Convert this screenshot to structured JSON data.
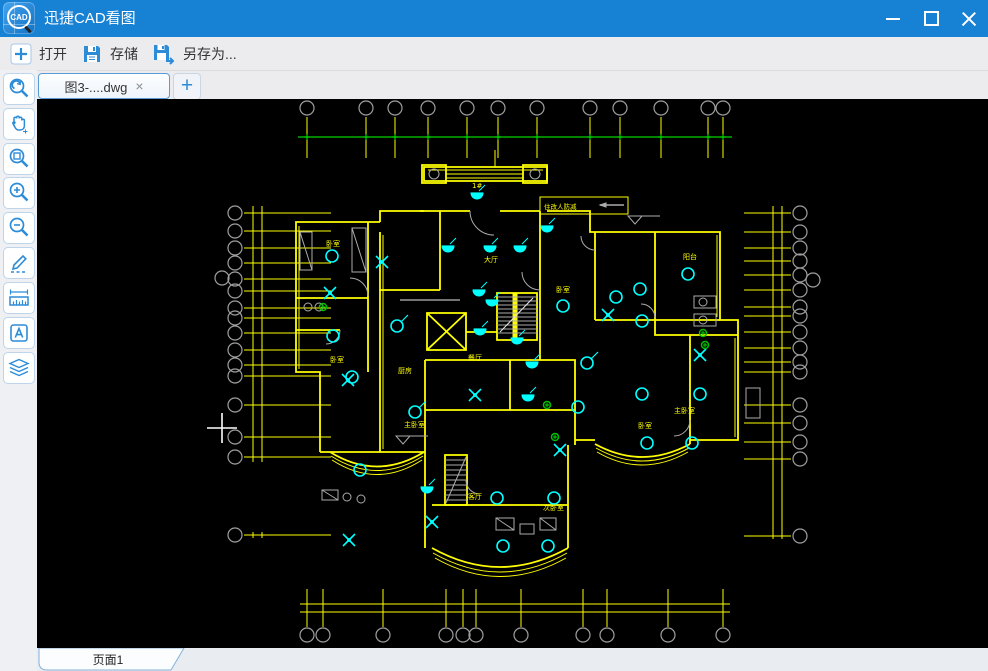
{
  "window": {
    "title": "迅捷CAD看图",
    "logo_text": "CAD",
    "controls": [
      "minimize-icon",
      "maximize-icon",
      "close-icon"
    ]
  },
  "toolbar": {
    "items": [
      {
        "label": "打开",
        "icon": "plus-box-icon"
      },
      {
        "label": "存储",
        "icon": "save-icon"
      },
      {
        "label": "另存为...",
        "icon": "save-as-icon"
      }
    ]
  },
  "tabs": {
    "active": {
      "label": "图3-....dwg",
      "close_glyph": "×"
    },
    "new_tab_glyph": "+"
  },
  "sidebar": {
    "tools": [
      "zoom-extents",
      "pan",
      "zoom-window",
      "zoom-in",
      "zoom-out",
      "draw",
      "measure",
      "text",
      "layers"
    ]
  },
  "statusbar": {
    "page_tab": "页面1"
  },
  "drawing": {
    "palette": {
      "wall": "#ffff00",
      "symbol": "#00ffff",
      "axis": "#9f9f9f",
      "datum": "#00d400",
      "detail": "#ababab",
      "green": "#00c000",
      "label": "#ffff00",
      "cursor": "#ffffff",
      "white": "#e8e8e8"
    },
    "axis_top": {
      "cy": 108,
      "r": 7,
      "xs": [
        307,
        366,
        395,
        428,
        467,
        498,
        537,
        590,
        620,
        661,
        708,
        723
      ],
      "tick": [
        117,
        158
      ],
      "datum_y": 137,
      "datum_x": [
        298,
        732
      ]
    },
    "axis_bottom": {
      "cy": 635,
      "r": 7,
      "xs": [
        307,
        323,
        383,
        446,
        463,
        476,
        521,
        583,
        607,
        668,
        723
      ],
      "tick": [
        589,
        627
      ],
      "hlines": [
        604,
        612
      ],
      "hx": [
        300,
        730
      ]
    },
    "axis_left": {
      "cx": 235,
      "r": 7,
      "ys": [
        213,
        231,
        248,
        263,
        279,
        291,
        308,
        318,
        333,
        350,
        365,
        376,
        405,
        437,
        457,
        535
      ],
      "extra": [
        222,
        278
      ],
      "tick": [
        244,
        331
      ],
      "vxs": [
        253,
        262
      ],
      "vy": [
        206,
        462
      ]
    },
    "axis_right": {
      "cx": 800,
      "r": 7,
      "ys": [
        213,
        232,
        248,
        261,
        275,
        290,
        307,
        316,
        332,
        348,
        362,
        372,
        405,
        423,
        442,
        459,
        536
      ],
      "extra": [
        813,
        280
      ],
      "tick": [
        744,
        791
      ],
      "vxs": [
        773,
        782
      ],
      "vy": [
        206,
        537
      ]
    },
    "walls": [
      "M380,222 H296 V372 H320 V452",
      "M380,222 V211 H424",
      "M424,167 H547 V181 H424 Z",
      "M422,165 H446 V183 H422 Z",
      "M523,165 H547 V183 H523 Z",
      "M420,211 H470 M500,211 H540",
      "M440,211 V290",
      "M540,211 V360",
      "M547,211 H590 V232 H720 V320 H738 V440 H690",
      "M595,232 V320",
      "M655,232 V320",
      "M595,320 H720",
      "M655,320 V335 H738",
      "M690,335 V444",
      "M380,232 V452",
      "M368,222 V372",
      "M296,298 H368",
      "M296,330 H340",
      "M380,290 H440",
      "M425,360 H540",
      "M425,360 V452",
      "M510,360 V410",
      "M425,410 H575",
      "M540,360 H575 V445",
      "M320,452 H425",
      "M425,452 V548",
      "M568,548 V445",
      "M575,440 H595",
      "M432,505 H568",
      "M427,313 H466 V350 H427 Z",
      "M427,313 L466,350 M466,313 L427,350",
      "M497,293 H537 V340 H497 Z",
      "M445,455 H467 V505 H445 Z",
      "M466,332 H497",
      "M330,452 Q377,481 424,452",
      "M432,548 Q500,586 568,548",
      "M595,444 Q642,470 690,444"
    ],
    "thick": [
      "M515,293 V340"
    ],
    "thin": [
      "M299,226 V369",
      "M383,235 V449",
      "M717,235 V317",
      "M735,338 V437",
      "M428,170 H543",
      "M446,174 H523",
      "M446,178 H523",
      "M495,150 V167",
      "M331,456 Q377,485 423,456",
      "M332,460 Q377,489 422,460",
      "M433,553 Q500,591 567,553",
      "M435,558 Q500,595 566,558",
      "M596,448 Q642,474 689,448",
      "M597,452 Q642,478 688,452"
    ],
    "gray": [
      "M497,297 H537 M497,301 H537 M497,305 H537 M497,309 H537 M497,313 H537 M497,317 H537 M497,321 H537 M497,325 H537 M497,329 H537 M497,333 H537",
      "M445,460 H467 M445,465 H467 M445,470 H467 M445,475 H467 M445,480 H467 M445,485 H467 M445,490 H467 M445,495 H467 M445,500 H467",
      "M446,503 L466,457",
      "M470,211 A24,24 0 0 0 494,235",
      "M368,296 A18,18 0 0 0 350,278",
      "M340,330 A14,14 0 0 1 326,344",
      "M540,290 A18,18 0 0 1 522,272",
      "M655,318 A14,14 0 0 0 641,304",
      "M690,420 A16,16 0 0 1 674,436",
      "M466,480 A14,14 0 0 0 480,494",
      "M595,250 A14,14 0 0 1 581,236",
      "M352,228 h14 v44 h-14 Z",
      "M352,228 l14,44",
      "M300,232 h12 v38 h-12 Z",
      "M300,232 l12,38",
      "M694,296 h22 v12 h-22 Z",
      "M694,314 h22 v12 h-22 Z",
      "M496,518 h18 v12 h-18 Z",
      "M496,518 l18,12",
      "M520,524 h14 v10 h-14 Z",
      "M540,518 h16 v12 h-16 Z",
      "M540,518 l16,12",
      "M746,388 h14 v30 h-14 Z",
      "M322,490 h16 v10 h-16 Z",
      "M322,490 l16,10"
    ],
    "gray_circles": [
      [
        434,
        174,
        5
      ],
      [
        535,
        174,
        5
      ],
      [
        308,
        307,
        4
      ],
      [
        319,
        307,
        4
      ],
      [
        347,
        497,
        4
      ],
      [
        361,
        499,
        4
      ],
      [
        703,
        302,
        4
      ],
      [
        703,
        320,
        4
      ]
    ],
    "white_paths": [
      "M500,332 L533,298",
      "M400,300 H460"
    ],
    "lamps": [
      [
        332,
        256
      ],
      [
        333,
        336
      ],
      [
        397,
        326
      ],
      [
        352,
        377
      ],
      [
        415,
        412
      ],
      [
        360,
        470
      ],
      [
        578,
        407
      ],
      [
        497,
        498
      ],
      [
        554,
        498
      ],
      [
        503,
        546
      ],
      [
        548,
        546
      ],
      [
        647,
        443
      ],
      [
        692,
        443
      ],
      [
        688,
        274
      ],
      [
        640,
        289
      ],
      [
        642,
        321
      ],
      [
        642,
        394
      ],
      [
        700,
        394
      ],
      [
        563,
        306
      ],
      [
        587,
        363
      ],
      [
        616,
        297
      ]
    ],
    "lamp_tails": [
      [
        397,
        326
      ],
      [
        415,
        412
      ],
      [
        587,
        363
      ]
    ],
    "fans": [
      [
        382,
        262
      ],
      [
        330,
        293
      ],
      [
        608,
        315
      ],
      [
        700,
        355
      ],
      [
        348,
        380
      ],
      [
        560,
        450
      ],
      [
        475,
        395
      ],
      [
        432,
        522
      ],
      [
        349,
        540
      ]
    ],
    "downlights": [
      [
        477,
        193
      ],
      [
        448,
        246
      ],
      [
        490,
        246
      ],
      [
        520,
        246
      ],
      [
        547,
        226
      ],
      [
        479,
        290
      ],
      [
        492,
        300
      ],
      [
        480,
        329
      ],
      [
        517,
        338
      ],
      [
        532,
        362
      ],
      [
        528,
        395
      ],
      [
        427,
        487
      ]
    ],
    "greens": [
      [
        323,
        307
      ],
      [
        703,
        333
      ],
      [
        705,
        345
      ],
      [
        547,
        405
      ],
      [
        555,
        437
      ]
    ],
    "labels": [
      {
        "t": "1#",
        "x": 472,
        "y": 188
      },
      {
        "t": "卧室",
        "x": 326,
        "y": 246
      },
      {
        "t": "卧室",
        "x": 330,
        "y": 362
      },
      {
        "t": "大厅",
        "x": 484,
        "y": 262
      },
      {
        "t": "厨房",
        "x": 398,
        "y": 373
      },
      {
        "t": "餐厅",
        "x": 468,
        "y": 360
      },
      {
        "t": "卧室",
        "x": 556,
        "y": 292
      },
      {
        "t": "阳台",
        "x": 683,
        "y": 259
      },
      {
        "t": "主卧室",
        "x": 674,
        "y": 413
      },
      {
        "t": "主卧室",
        "x": 404,
        "y": 427
      },
      {
        "t": "客厅",
        "x": 468,
        "y": 499
      },
      {
        "t": "次卧室",
        "x": 543,
        "y": 510
      },
      {
        "t": "卧室",
        "x": 638,
        "y": 428
      }
    ],
    "note": {
      "text": "住改人防减",
      "box": [
        540,
        197,
        88,
        17
      ],
      "tx": 544,
      "ty": 209,
      "arrow": [
        600,
        205,
        624,
        205
      ]
    },
    "levels": [
      [
        628,
        216
      ],
      [
        396,
        436
      ]
    ],
    "cursor": {
      "x": 222,
      "y": 428,
      "arm": 15
    }
  }
}
